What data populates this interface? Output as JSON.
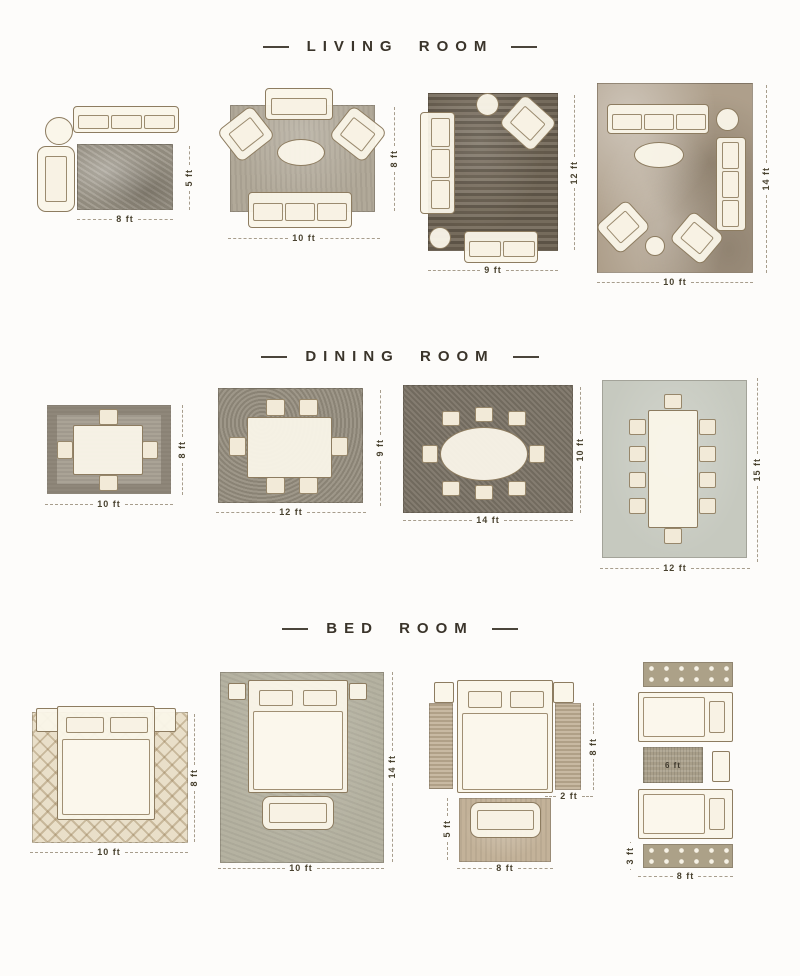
{
  "page": {
    "background": "#fdfcfa"
  },
  "colors": {
    "title_text": "#3a342a",
    "dimension_text": "#49422f",
    "furniture_fill": "#faf5e9",
    "furniture_outline": "#8d7c60"
  },
  "sections": {
    "living": {
      "title": "LIVING ROOM",
      "layouts": [
        {
          "width": "8 ft",
          "height": "5 ft"
        },
        {
          "width": "10 ft",
          "height": "8 ft"
        },
        {
          "width": "9 ft",
          "height": "12 ft"
        },
        {
          "width": "10 ft",
          "height": "14 ft"
        }
      ]
    },
    "dining": {
      "title": "DINING ROOM",
      "layouts": [
        {
          "width": "10 ft",
          "height": "8 ft"
        },
        {
          "width": "12 ft",
          "height": "9 ft"
        },
        {
          "width": "14 ft",
          "height": "10 ft"
        },
        {
          "width": "12 ft",
          "height": "15 ft"
        }
      ]
    },
    "bedroom": {
      "title": "BED ROOM",
      "layouts": [
        {
          "width": "10 ft",
          "height": "8 ft"
        },
        {
          "width": "10 ft",
          "height": "14 ft"
        },
        {
          "side_runner_height": "8 ft",
          "side_runner_width": "2 ft",
          "foot_rug_height": "5 ft",
          "foot_rug_width": "8 ft"
        },
        {
          "between_rug_width": "6 ft",
          "runner_height": "3 ft",
          "runner_width": "8 ft"
        }
      ]
    }
  }
}
